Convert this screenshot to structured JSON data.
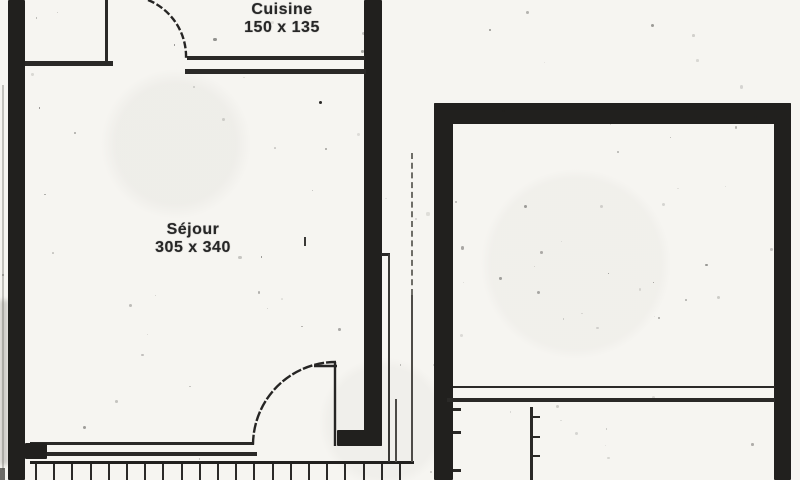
{
  "plan": {
    "rooms": [
      {
        "name": "Cuisine",
        "dimensions": "150 x 135"
      },
      {
        "name": "Séjour",
        "dimensions": "305 x 340"
      }
    ]
  },
  "colors": {
    "ink": "#21201e",
    "paper": "#f6f5f1",
    "faint": "#c2c1bc"
  }
}
